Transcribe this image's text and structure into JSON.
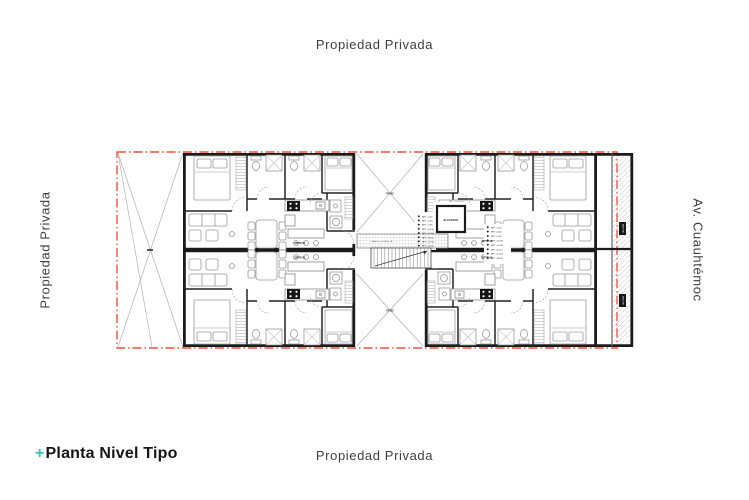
{
  "colors": {
    "accent": "#2fc7b8",
    "boundary": "#f0503c"
  },
  "surround": {
    "top": "Propiedad Privada",
    "bottom": "Propiedad Privada",
    "left": "Propiedad Privada",
    "right": "Av. Cuauhtémoc"
  },
  "legend": {
    "plus": "+",
    "title": "Planta Nivel Tipo"
  },
  "plan": {
    "elevator": "ELEVADOR",
    "corridor_note": "PASILLO DE REJILLA",
    "balcony": "BALCON",
    "patio": "PATIO",
    "units": {
      "u1": "DPTO 01",
      "u2": "DPTO 02",
      "u3": "DPTO 03",
      "u4": "DPTO 04"
    },
    "levels": [
      "NPT +2.52",
      "NPT +5.04",
      "NPT +7.56",
      "NPT +10.08",
      "NPT +12.60",
      "NPT +15.12",
      "NPT +17.64",
      "NPT +20.16"
    ]
  }
}
